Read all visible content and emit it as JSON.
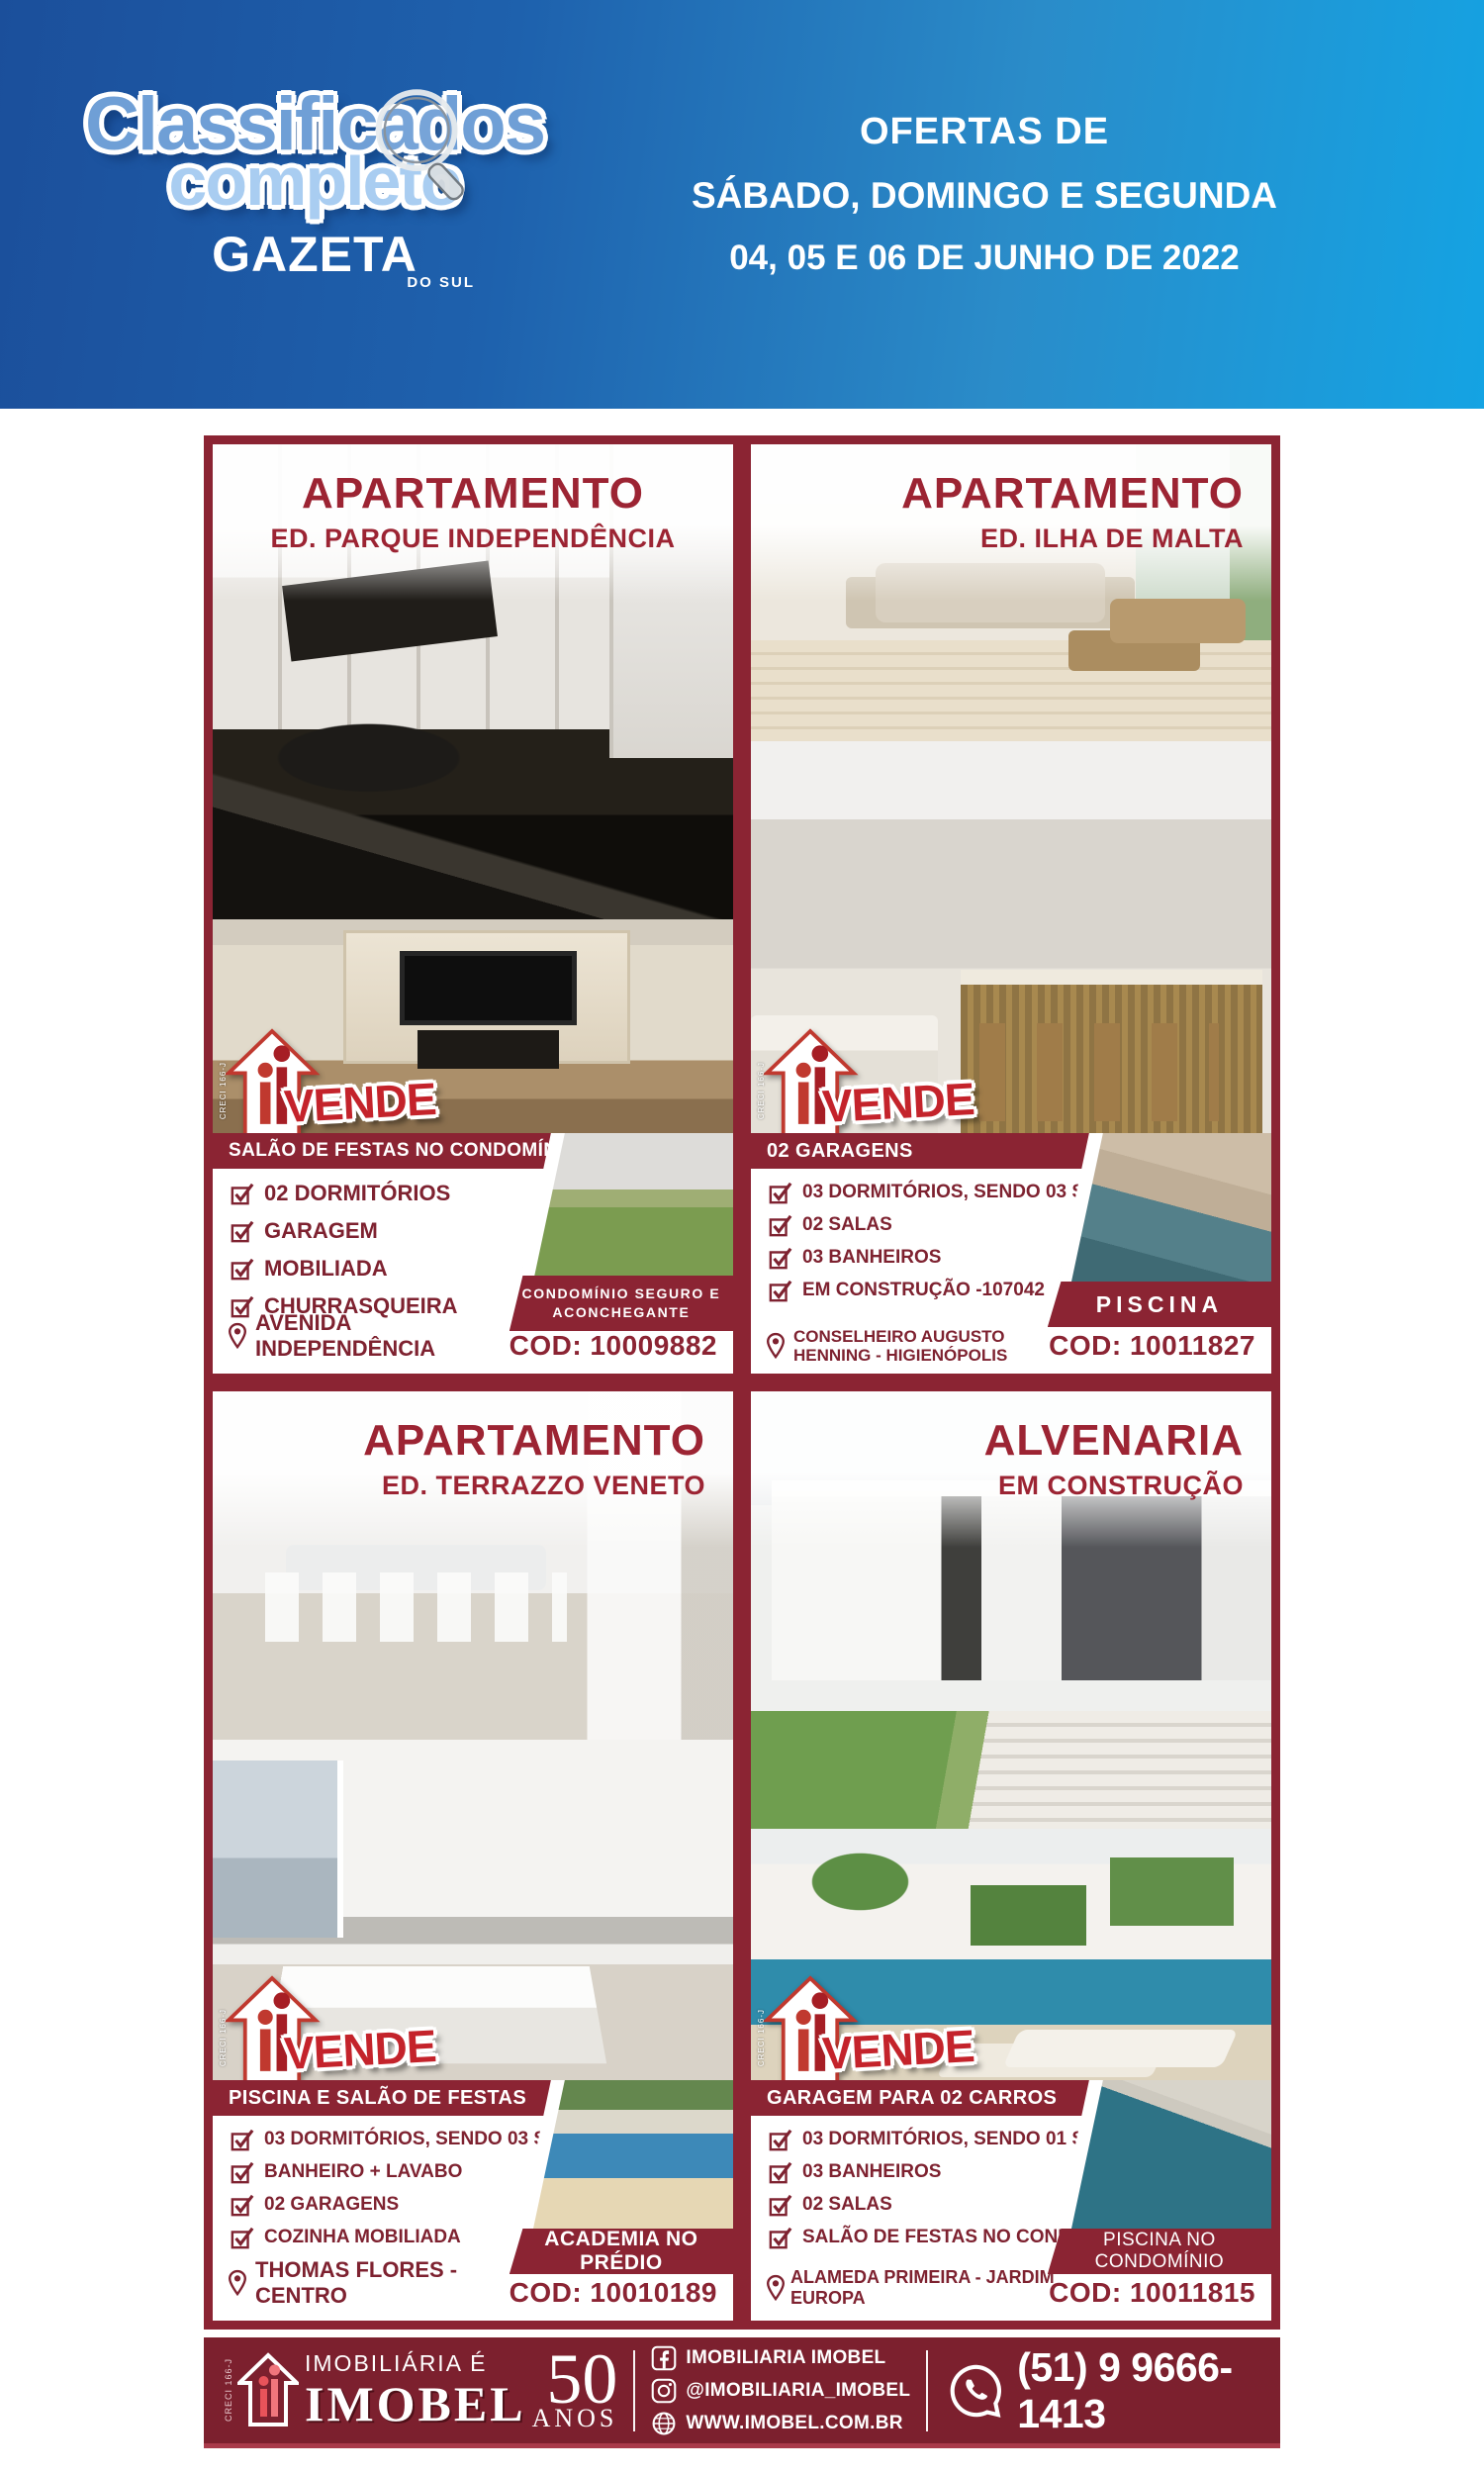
{
  "header": {
    "logo_line1": "Classificados",
    "logo_line2": "completo",
    "brand": "GAZETA",
    "brand_sub": "DO SUL",
    "offers_line1": "OFERTAS DE",
    "offers_line2": "SÁBADO, DOMINGO E SEGUNDA",
    "offers_line3": "04, 05 E 06 DE JUNHO DE 2022"
  },
  "vende": {
    "label": "VENDE",
    "creci": "CRECI 166-J"
  },
  "listings": [
    {
      "title": "APARTAMENTO",
      "subtitle": "ED. PARQUE INDEPENDÊNCIA",
      "banner": "SALÃO DE FESTAS NO CONDOMÍNIO",
      "features": [
        "02 DORMITÓRIOS",
        "GARAGEM",
        "MOBILIADA",
        "CHURRASQUEIRA"
      ],
      "location": "AVENIDA INDEPENDÊNCIA",
      "badge": "CONDOMÍNIO SEGURO E ACONCHEGANTE",
      "code": "COD: 10009882",
      "photos": [
        "kitchen",
        "living-room-tv",
        "condo-garden-pergola"
      ]
    },
    {
      "title": "APARTAMENTO",
      "subtitle": "ED. ILHA DE MALTA",
      "banner": "02 GARAGENS",
      "features": [
        "03 DORMITÓRIOS, SENDO 03 SUÍTES",
        "02 SALAS",
        "03 BANHEIROS",
        "EM CONSTRUÇÃO -107042"
      ],
      "location": "CONSELHEIRO AUGUSTO HENNING - HIGIENÓPOLIS",
      "badge": "PISCINA",
      "code": "COD: 10011827",
      "photos": [
        "living-room-render",
        "kitchen-bar-render",
        "pool-terrace"
      ]
    },
    {
      "title": "APARTAMENTO",
      "subtitle": "ED. TERRAZZO VENETO",
      "banner": "PISCINA E SALÃO DE FESTAS",
      "features": [
        "03 DORMITÓRIOS, SENDO 03 SUÍTES",
        "BANHEIRO + LAVABO",
        "02 GARAGENS",
        "COZINHA MOBILIADA"
      ],
      "location": "THOMAS FLORES - CENTRO",
      "badge": "ACADEMIA NO PRÉDIO",
      "code": "COD: 10010189",
      "photos": [
        "dining-room",
        "living-room-table",
        "pool-umbrella"
      ]
    },
    {
      "title": "ALVENARIA",
      "subtitle": "EM CONSTRUÇÃO",
      "banner": "GARAGEM PARA 02 CARROS",
      "features": [
        "03 DORMITÓRIOS, SENDO 01 SUÍTE",
        "03 BANHEIROS",
        "02 SALAS",
        "SALÃO DE FESTAS NO CONDOMÍNIO"
      ],
      "location": "ALAMEDA PRIMEIRA - JARDIM EUROPA",
      "badge": "PISCINA NO CONDOMÍNIO",
      "code": "COD: 10011815",
      "photos": [
        "house-exterior-render",
        "backyard-pool-render",
        "pool-closeup"
      ]
    }
  ],
  "footer": {
    "creci": "CRECI 166-J",
    "tagline": "IMOBILIÁRIA É",
    "brand": "IMOBEL",
    "years_number": "50",
    "years_label": "ANOS",
    "facebook": "IMOBILIARIA IMOBEL",
    "instagram": "@IMOBILIARIA_IMOBEL",
    "website": "WWW.IMOBEL.COM.BR",
    "phone": "(51) 9 9666-1413"
  },
  "icons": {
    "magnifier": "magnifying-glass over logo",
    "checkbox": "checked-square",
    "pin": "map-pin",
    "facebook": "facebook-square",
    "instagram": "instagram-square",
    "globe": "globe-web",
    "whatsapp": "whatsapp-bubble",
    "house": "imobel-house-arrow"
  },
  "colors": {
    "maroon": "#8b2433",
    "maroon_dark": "#7c202e",
    "title_red": "#9c2433",
    "header_blue_left": "#1b4f9b",
    "header_blue_right": "#14a3e3",
    "logo_blue_1": "#6f9fd6",
    "logo_blue_2": "#a9cdf1"
  }
}
